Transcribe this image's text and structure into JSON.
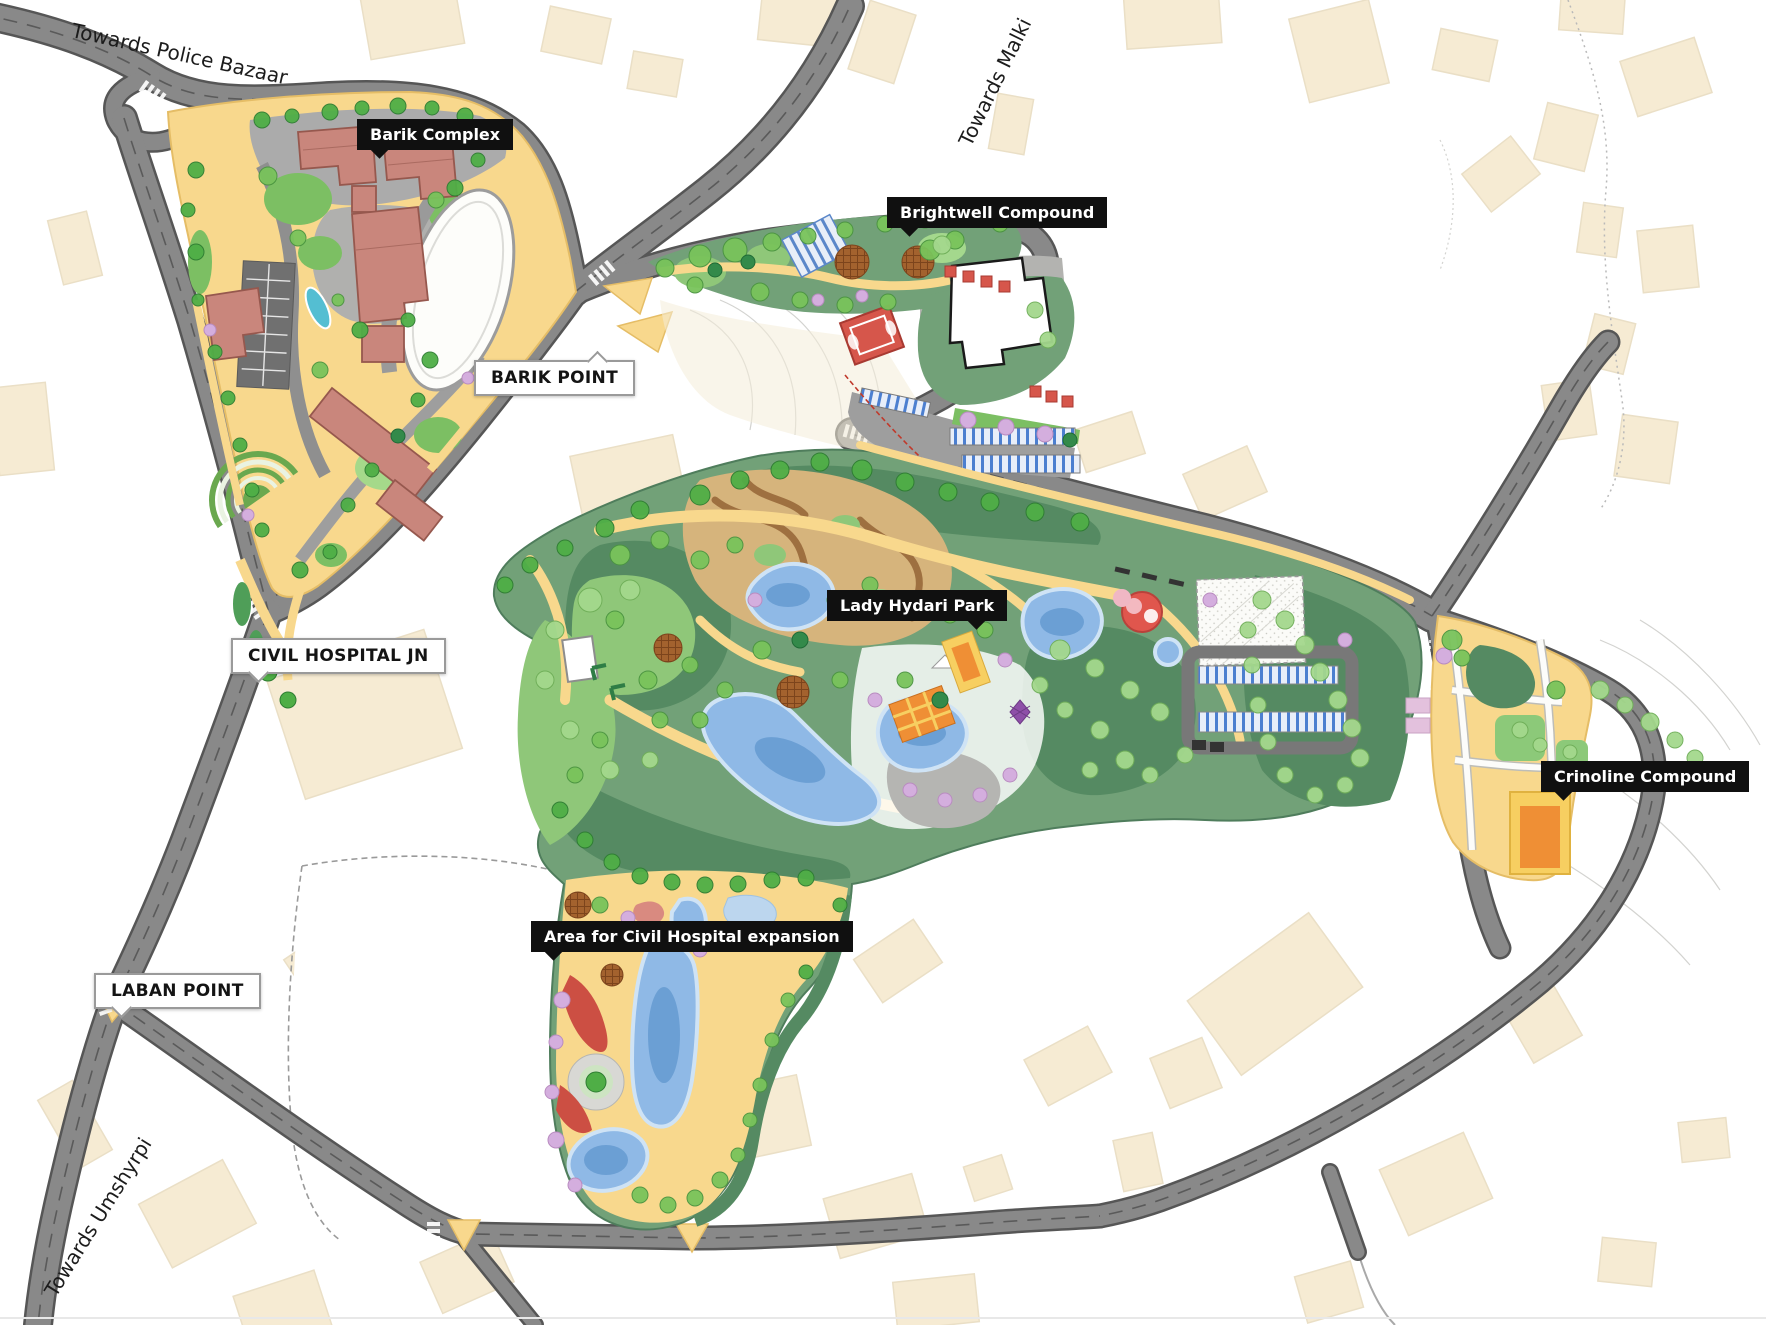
{
  "map": {
    "type": "urban-masterplan-map",
    "callouts": [
      {
        "id": "barik-complex",
        "text": "Barik Complex",
        "style": "dark"
      },
      {
        "id": "brightwell-compound",
        "text": "Brightwell Compound",
        "style": "dark"
      },
      {
        "id": "barik-point",
        "text": "BARIK POINT",
        "style": "light"
      },
      {
        "id": "lady-hydari-park",
        "text": "Lady Hydari Park",
        "style": "dark"
      },
      {
        "id": "civil-hospital-jn",
        "text": "CIVIL HOSPITAL JN",
        "style": "light"
      },
      {
        "id": "crinoline-compound",
        "text": "Crinoline Compound",
        "style": "dark"
      },
      {
        "id": "civil-hospital-expansion",
        "text": "Area for Civil Hospital expansion",
        "style": "dark"
      },
      {
        "id": "laban-point",
        "text": "LABAN POINT",
        "style": "light"
      }
    ],
    "road_labels": [
      {
        "id": "police-bazaar",
        "text": "Towards Police Bazaar"
      },
      {
        "id": "malki",
        "text": "Towards Malki"
      },
      {
        "id": "umshyrpi",
        "text": "Towards Umshyrpi"
      }
    ]
  },
  "palette": {
    "labelDark": "#101010",
    "beige": "#f6ebd3",
    "beigeEdge": "#eadfc6",
    "road": "#898989",
    "roadDark": "#565656",
    "sand": "#f8d88d",
    "sandEdge": "#e5bd66",
    "parkMid": "#72a178",
    "parkDark": "#558a62",
    "parkLight": "#8fc779",
    "maze": "#d6b47c",
    "mazePath": "#9e7040",
    "pond": "#8fb9e6",
    "pondDeep": "#6b9fd4",
    "pondEdge": "#cfe3f5",
    "salmon": "#c9867c",
    "salmonEdge": "#96584e",
    "teal": "#54bed2",
    "orange": "#ef8f35",
    "orangeLight": "#f7cf61",
    "red": "#d6564b",
    "parkingBlue": "#4c7fd0",
    "purpleTree": "#d4aede",
    "grayPlaza": "#ababab"
  }
}
